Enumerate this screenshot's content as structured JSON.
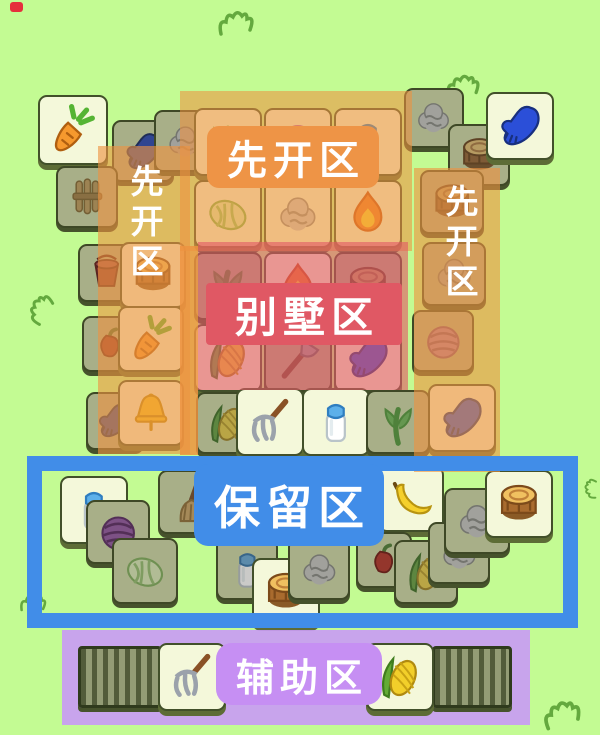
{
  "scene": {
    "description": "Sheep-a-Sheep tile board screenshot annotated with strategy zones"
  },
  "colors": {
    "bg": "#c3fb93",
    "orange": "#ed9340",
    "orange_solid": "#ee9446",
    "red": "#e25a66",
    "red_solid": "#e05864",
    "blue": "#418de8",
    "purple": "#c99cf3",
    "purple_solid": "#c68ff3",
    "tile_face": "#f4f8da",
    "tile_face_dark": "#a8af88",
    "grass_stroke": "#64a93e",
    "dot_red": "#e5303c"
  },
  "zones": {
    "open_top": {
      "label": "先开区"
    },
    "open_left": {
      "label": "先开区"
    },
    "open_right": {
      "label": "先开区"
    },
    "villa": {
      "label": "别墅区"
    },
    "reserve": {
      "label": "保留区"
    },
    "assist": {
      "label": "辅助区"
    }
  },
  "board": {
    "tiles": [
      [
        38,
        95,
        70,
        "carrot",
        "b"
      ],
      [
        112,
        120,
        62,
        "glove",
        "d"
      ],
      [
        154,
        110,
        62,
        "wool",
        "d"
      ],
      [
        56,
        166,
        62,
        "wheat",
        "d"
      ],
      [
        78,
        244,
        58,
        "bucket",
        "d"
      ],
      [
        82,
        316,
        56,
        "pepper",
        "d"
      ],
      [
        86,
        392,
        58,
        "glove",
        "d"
      ],
      [
        120,
        242,
        66,
        "stump",
        "b"
      ],
      [
        118,
        306,
        66,
        "carrot",
        "b"
      ],
      [
        118,
        380,
        66,
        "bell",
        "b"
      ],
      [
        404,
        88,
        60,
        "wool",
        "d"
      ],
      [
        448,
        124,
        62,
        "stump",
        "d"
      ],
      [
        486,
        92,
        68,
        "glove",
        "b"
      ],
      [
        420,
        170,
        64,
        "stump",
        "d"
      ],
      [
        422,
        242,
        64,
        "wool",
        "d"
      ],
      [
        412,
        310,
        62,
        "yarn_pink",
        "d"
      ],
      [
        428,
        384,
        68,
        "glove",
        "b"
      ],
      [
        194,
        108,
        68,
        "greens",
        "b"
      ],
      [
        264,
        108,
        68,
        "yarn_pink",
        "b"
      ],
      [
        334,
        108,
        68,
        "milk",
        "b"
      ],
      [
        194,
        180,
        68,
        "cabbage",
        "b"
      ],
      [
        264,
        180,
        68,
        "wool",
        "b"
      ],
      [
        334,
        180,
        68,
        "fire",
        "b"
      ],
      [
        194,
        252,
        68,
        "greens",
        "d"
      ],
      [
        264,
        252,
        68,
        "fire",
        "b"
      ],
      [
        334,
        252,
        68,
        "stump",
        "d"
      ],
      [
        194,
        324,
        68,
        "corn",
        "b"
      ],
      [
        264,
        324,
        68,
        "axe",
        "d"
      ],
      [
        334,
        324,
        68,
        "glove",
        "b"
      ],
      [
        196,
        392,
        62,
        "corn",
        "d"
      ],
      [
        236,
        388,
        68,
        "fork",
        "b"
      ],
      [
        302,
        388,
        68,
        "milk",
        "b"
      ],
      [
        366,
        390,
        64,
        "greens",
        "d"
      ],
      [
        60,
        476,
        68,
        "milk",
        "b"
      ],
      [
        86,
        500,
        64,
        "yarn_purple",
        "d"
      ],
      [
        112,
        538,
        66,
        "cabbage",
        "d"
      ],
      [
        158,
        470,
        64,
        "broom",
        "d"
      ],
      [
        216,
        538,
        62,
        "milk",
        "d"
      ],
      [
        252,
        558,
        68,
        "stump",
        "b"
      ],
      [
        288,
        538,
        62,
        "wool",
        "d"
      ],
      [
        378,
        466,
        66,
        "banana",
        "b"
      ],
      [
        356,
        532,
        56,
        "pepper",
        "d"
      ],
      [
        394,
        540,
        64,
        "corn",
        "d"
      ],
      [
        428,
        522,
        62,
        "wool",
        "d"
      ],
      [
        444,
        488,
        66,
        "wool",
        "d"
      ],
      [
        485,
        470,
        68,
        "stump",
        "b"
      ]
    ]
  },
  "assist_row": {
    "tiles": [
      [
        158,
        643,
        68,
        "fork",
        "b"
      ],
      [
        366,
        643,
        68,
        "corn",
        "b"
      ]
    ],
    "stacks": [
      {
        "x": 78,
        "y": 646,
        "w": 84,
        "h": 62
      },
      {
        "x": 432,
        "y": 646,
        "w": 80,
        "h": 62
      }
    ]
  },
  "decor": {
    "red_dot": {
      "x": 10,
      "y": 2,
      "w": 13,
      "h": 10
    },
    "tufts": [
      {
        "x": 212,
        "y": 8,
        "w": 50,
        "h": 30,
        "r": 0
      },
      {
        "x": 440,
        "y": 72,
        "w": 48,
        "h": 28,
        "r": 0
      },
      {
        "x": 24,
        "y": 290,
        "w": 34,
        "h": 36,
        "r": -50
      },
      {
        "x": 10,
        "y": 592,
        "w": 48,
        "h": 22,
        "r": 5
      },
      {
        "x": 540,
        "y": 698,
        "w": 46,
        "h": 32,
        "r": -10
      },
      {
        "x": 580,
        "y": 466,
        "w": 22,
        "h": 44,
        "r": -80
      }
    ]
  }
}
